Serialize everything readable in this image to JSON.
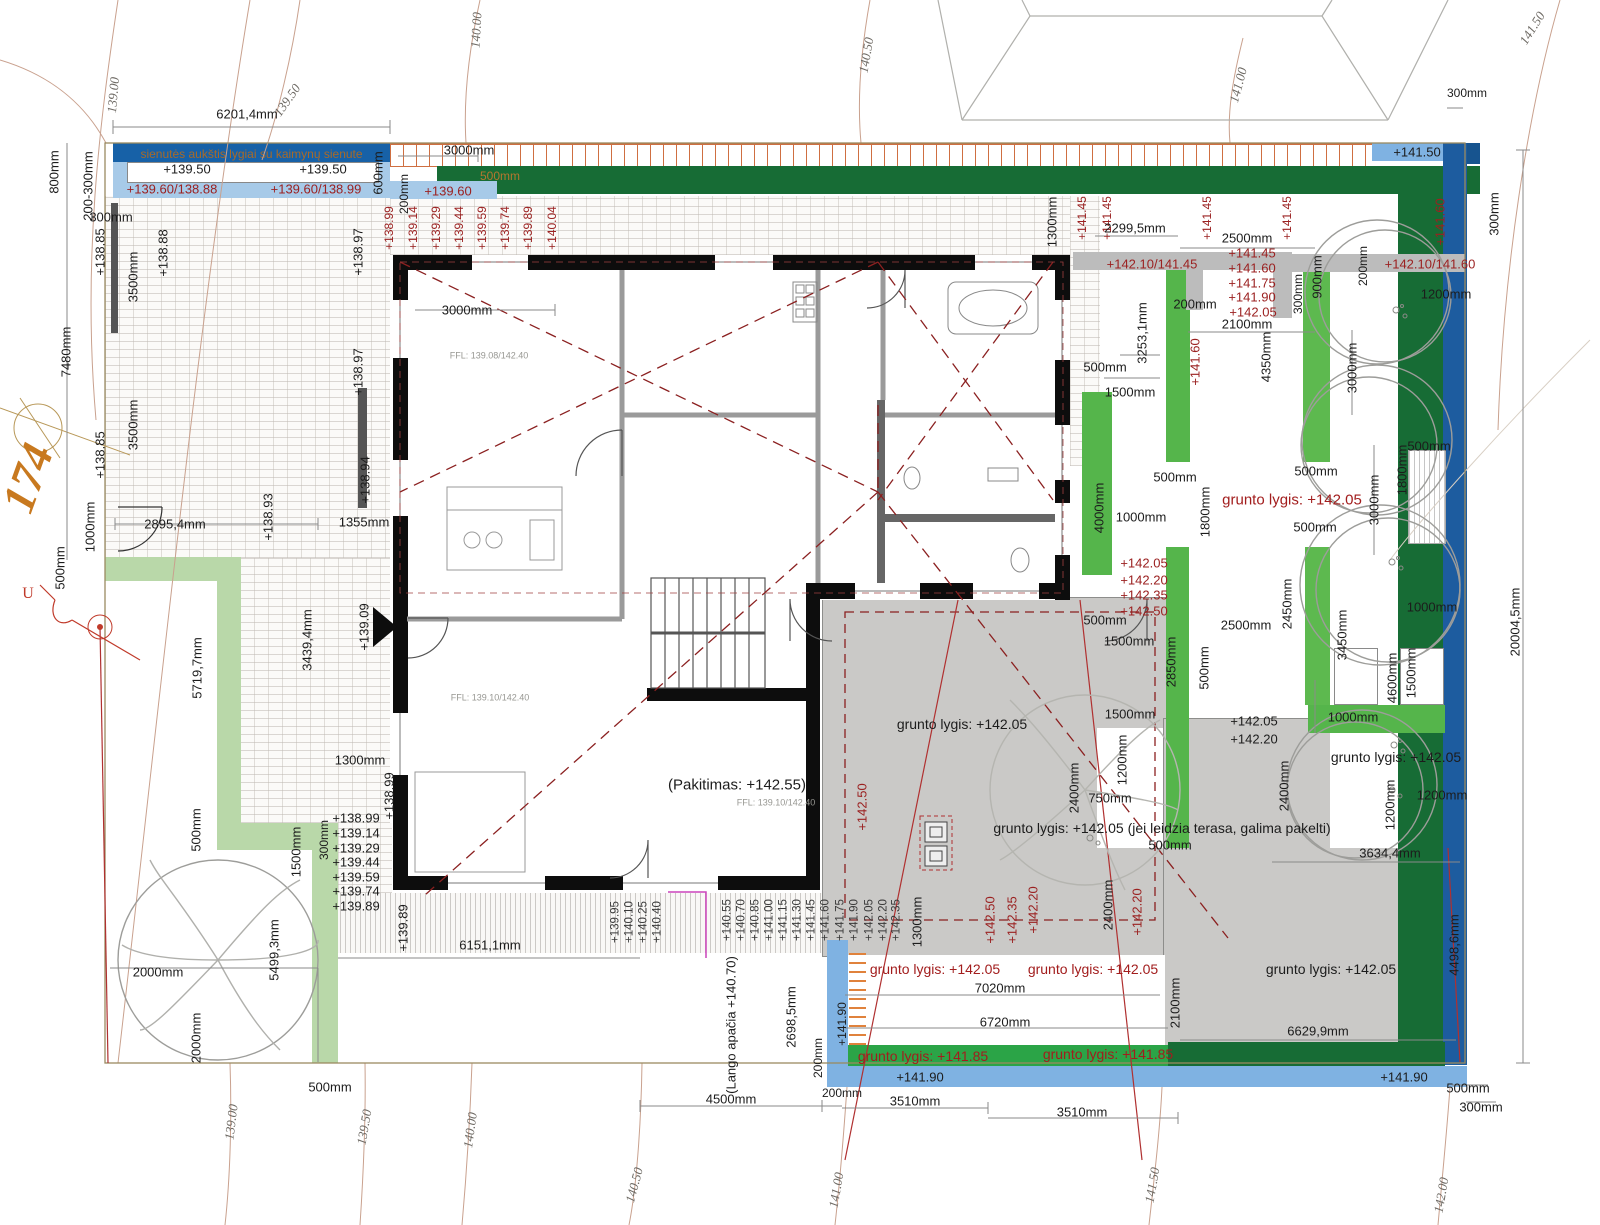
{
  "header": {
    "wall_note": "sienutės aukštis lygiai su kaimynų sienute"
  },
  "colors": {
    "navy_bar": "#1761a7",
    "light_blue": "#a7cae8",
    "blue_strip": "#7fb2e2",
    "dark_green": "#176c35",
    "bright_green": "#55b54b",
    "bottom_green": "#2ba447",
    "pale_green": "#b9d8a9",
    "terrace_gray": "#cac9c7",
    "wall_gray": "#bcbcbc",
    "elevation_red": "#9b2121",
    "fence_orange": "#cf6f41",
    "wall_black": "#0d0d0d",
    "right_blue": "#1d5c9f"
  },
  "labels": [
    {
      "t": "139.00",
      "x": 113,
      "y": 95,
      "r": -85,
      "c": "ct"
    },
    {
      "t": "139.50",
      "x": 287,
      "y": 100,
      "r": -55,
      "c": "ct"
    },
    {
      "t": "140.00",
      "x": 476,
      "y": 30,
      "r": -87,
      "c": "ct"
    },
    {
      "t": "140.50",
      "x": 866,
      "y": 55,
      "r": -80,
      "c": "ct"
    },
    {
      "t": "141.00",
      "x": 1238,
      "y": 85,
      "r": -75,
      "c": "ct"
    },
    {
      "t": "141.50",
      "x": 1532,
      "y": 28,
      "r": -58,
      "c": "ct"
    },
    {
      "t": "139.00",
      "x": 231,
      "y": 1122,
      "r": -83,
      "c": "ct"
    },
    {
      "t": "139.50",
      "x": 364,
      "y": 1127,
      "r": -80,
      "c": "ct"
    },
    {
      "t": "140.00",
      "x": 470,
      "y": 1130,
      "r": -82,
      "c": "ct"
    },
    {
      "t": "140.50",
      "x": 634,
      "y": 1185,
      "r": -75,
      "c": "ct"
    },
    {
      "t": "141.00",
      "x": 836,
      "y": 1190,
      "r": -80,
      "c": "ct"
    },
    {
      "t": "141.50",
      "x": 1152,
      "y": 1185,
      "r": -80,
      "c": "ct"
    },
    {
      "t": "142.00",
      "x": 1441,
      "y": 1195,
      "r": -80,
      "c": "ct"
    },
    {
      "t": "6201,4mm",
      "x": 247,
      "y": 114
    },
    {
      "t": "200-300mm",
      "x": 88,
      "y": 186,
      "r": -90
    },
    {
      "t": "800mm",
      "x": 54,
      "y": 172,
      "r": -90
    },
    {
      "t": "+139.50",
      "x": 187,
      "y": 169
    },
    {
      "t": "+139.50",
      "x": 323,
      "y": 169
    },
    {
      "t": "+139.60/138.88",
      "x": 172,
      "y": 189,
      "c": "red"
    },
    {
      "t": "+139.60/138.99",
      "x": 316,
      "y": 189,
      "c": "red"
    },
    {
      "t": "600mm",
      "x": 378,
      "y": 173,
      "r": -90
    },
    {
      "t": "3000mm",
      "x": 469,
      "y": 150
    },
    {
      "t": "500mm",
      "x": 500,
      "y": 176,
      "c": "grn",
      "s": 12
    },
    {
      "t": "+139.60",
      "x": 448,
      "y": 191,
      "c": "red"
    },
    {
      "t": "200mm",
      "x": 404,
      "y": 194,
      "r": -90,
      "s": 12
    },
    {
      "t": "300mm",
      "x": 111,
      "y": 217
    },
    {
      "t": "+138.85",
      "x": 100,
      "y": 252,
      "r": -90
    },
    {
      "t": "3500mm",
      "x": 133,
      "y": 277,
      "r": -90
    },
    {
      "t": "+138.88",
      "x": 163,
      "y": 253,
      "r": -90
    },
    {
      "t": "+138.97",
      "x": 358,
      "y": 252,
      "r": -90
    },
    {
      "t": "+138.97",
      "x": 358,
      "y": 372,
      "r": -90
    },
    {
      "t": "3500mm",
      "x": 133,
      "y": 425,
      "r": -90
    },
    {
      "t": "+138.85",
      "x": 100,
      "y": 455,
      "r": -90
    },
    {
      "t": "+138.94",
      "x": 365,
      "y": 480,
      "r": -90
    },
    {
      "t": "+138.93",
      "x": 268,
      "y": 517,
      "r": -90
    },
    {
      "t": "7480mm",
      "x": 66,
      "y": 352,
      "r": -90
    },
    {
      "t": "174",
      "x": 28,
      "y": 478,
      "r": -70,
      "c": "big",
      "s": 46
    },
    {
      "t": "U",
      "x": 28,
      "y": 594,
      "c": "u",
      "s": 16
    },
    {
      "t": "1000mm",
      "x": 90,
      "y": 527,
      "r": -90
    },
    {
      "t": "500mm",
      "x": 60,
      "y": 568,
      "r": -90
    },
    {
      "t": "2895,4mm",
      "x": 175,
      "y": 524
    },
    {
      "t": "1355mm",
      "x": 364,
      "y": 522
    },
    {
      "t": "5719,7mm",
      "x": 197,
      "y": 668,
      "r": -90
    },
    {
      "t": "3439,4mm",
      "x": 307,
      "y": 640,
      "r": -90
    },
    {
      "t": "+139.09",
      "x": 364,
      "y": 627,
      "r": -90
    },
    {
      "t": "1300mm",
      "x": 360,
      "y": 760
    },
    {
      "t": "+138.99",
      "x": 389,
      "y": 796,
      "r": -90
    },
    {
      "t": "2000mm",
      "x": 158,
      "y": 972
    },
    {
      "t": "2000mm",
      "x": 196,
      "y": 1038,
      "r": -90
    },
    {
      "t": "5499,3mm",
      "x": 274,
      "y": 950,
      "r": -90
    },
    {
      "t": "500mm",
      "x": 196,
      "y": 830,
      "r": -90
    },
    {
      "t": "1500mm",
      "x": 296,
      "y": 852,
      "r": -90
    },
    {
      "t": "300mm",
      "x": 324,
      "y": 840,
      "r": -90,
      "s": 12
    },
    {
      "t": "+138.99",
      "x": 356,
      "y": 818
    },
    {
      "t": "+139.14",
      "x": 356,
      "y": 833
    },
    {
      "t": "+139.29",
      "x": 356,
      "y": 848
    },
    {
      "t": "+139.44",
      "x": 356,
      "y": 862
    },
    {
      "t": "+139.59",
      "x": 356,
      "y": 877
    },
    {
      "t": "+139.74",
      "x": 356,
      "y": 891
    },
    {
      "t": "+139.89",
      "x": 356,
      "y": 906
    },
    {
      "t": "+139.89",
      "x": 403,
      "y": 928,
      "r": -90
    },
    {
      "t": "6151,1mm",
      "x": 490,
      "y": 945
    },
    {
      "t": "500mm",
      "x": 330,
      "y": 1087
    },
    {
      "t": "1300mm",
      "x": 917,
      "y": 922,
      "r": -90
    },
    {
      "t": "+138.99",
      "x": 389,
      "y": 228,
      "r": -90,
      "c": "red",
      "s": 12
    },
    {
      "t": "+139.14",
      "x": 413,
      "y": 228,
      "r": -90,
      "c": "red",
      "s": 12
    },
    {
      "t": "+139.29",
      "x": 436,
      "y": 228,
      "r": -90,
      "c": "red",
      "s": 12
    },
    {
      "t": "+139.44",
      "x": 459,
      "y": 228,
      "r": -90,
      "c": "red",
      "s": 12
    },
    {
      "t": "+139.59",
      "x": 482,
      "y": 228,
      "r": -90,
      "c": "red",
      "s": 12
    },
    {
      "t": "+139.74",
      "x": 505,
      "y": 228,
      "r": -90,
      "c": "red",
      "s": 12
    },
    {
      "t": "+139.89",
      "x": 528,
      "y": 228,
      "r": -90,
      "c": "red",
      "s": 12
    },
    {
      "t": "+140.04",
      "x": 552,
      "y": 228,
      "r": -90,
      "c": "red",
      "s": 12
    },
    {
      "t": "3000mm",
      "x": 467,
      "y": 310
    },
    {
      "t": "FFL: 139.08/142.40",
      "x": 489,
      "y": 356,
      "c": "ffl",
      "s": 9
    },
    {
      "t": "FFL: 139.10/142.40",
      "x": 490,
      "y": 698,
      "c": "ffl",
      "s": 9
    },
    {
      "t": "(Pakitimas: +142.55)",
      "x": 737,
      "y": 785,
      "s": 15
    },
    {
      "t": "FFL: 139.10/142.40",
      "x": 776,
      "y": 803,
      "c": "ffl",
      "s": 9
    },
    {
      "t": "+139.95",
      "x": 616,
      "y": 922,
      "r": -90,
      "c": "drk",
      "s": 11.5
    },
    {
      "t": "+140.10",
      "x": 630,
      "y": 922,
      "r": -90,
      "c": "drk",
      "s": 11.5
    },
    {
      "t": "+140.25",
      "x": 644,
      "y": 922,
      "r": -90,
      "c": "drk",
      "s": 11.5
    },
    {
      "t": "+140.40",
      "x": 658,
      "y": 922,
      "r": -90,
      "c": "drk",
      "s": 11.5
    },
    {
      "t": "+140.55",
      "x": 728,
      "y": 920,
      "r": -90,
      "c": "drk",
      "s": 11.5
    },
    {
      "t": "+140.70",
      "x": 742,
      "y": 920,
      "r": -90,
      "c": "drk",
      "s": 11.5
    },
    {
      "t": "+140.85",
      "x": 756,
      "y": 920,
      "r": -90,
      "c": "drk",
      "s": 11.5
    },
    {
      "t": "+141.00",
      "x": 770,
      "y": 920,
      "r": -90,
      "c": "drk",
      "s": 11.5
    },
    {
      "t": "+141.15",
      "x": 784,
      "y": 920,
      "r": -90,
      "c": "drk",
      "s": 11.5
    },
    {
      "t": "+141.30",
      "x": 798,
      "y": 920,
      "r": -90,
      "c": "drk",
      "s": 11.5
    },
    {
      "t": "+141.45",
      "x": 812,
      "y": 920,
      "r": -90,
      "c": "drk",
      "s": 11.5
    },
    {
      "t": "+141.60",
      "x": 826,
      "y": 920,
      "r": -90,
      "c": "drk",
      "s": 11.5
    },
    {
      "t": "+141.75",
      "x": 841,
      "y": 920,
      "r": -90,
      "c": "drk",
      "s": 11.5
    },
    {
      "t": "+141.90",
      "x": 855,
      "y": 920,
      "r": -90,
      "c": "drk",
      "s": 11.5
    },
    {
      "t": "+142.05",
      "x": 870,
      "y": 920,
      "r": -90,
      "c": "drk",
      "s": 11.5
    },
    {
      "t": "+142.20",
      "x": 884,
      "y": 920,
      "r": -90,
      "c": "drk",
      "s": 11.5
    },
    {
      "t": "+142.35",
      "x": 897,
      "y": 920,
      "r": -90,
      "c": "drk",
      "s": 11.5
    },
    {
      "t": "(Lango apačia +140.70)",
      "x": 731,
      "y": 1025,
      "r": -90
    },
    {
      "t": "2698,5mm",
      "x": 791,
      "y": 1017,
      "r": -90
    },
    {
      "t": "200mm",
      "x": 818,
      "y": 1058,
      "r": -90,
      "s": 12
    },
    {
      "t": "+141.90",
      "x": 842,
      "y": 1024,
      "r": -90,
      "s": 12
    },
    {
      "t": "4500mm",
      "x": 731,
      "y": 1099
    },
    {
      "t": "200mm",
      "x": 842,
      "y": 1093,
      "s": 12
    },
    {
      "t": "3510mm",
      "x": 915,
      "y": 1101
    },
    {
      "t": "3510mm",
      "x": 1082,
      "y": 1112
    },
    {
      "t": "grunto lygis: +142.05",
      "x": 935,
      "y": 969,
      "c": "grl",
      "s": 14
    },
    {
      "t": "grunto lygis: +142.05",
      "x": 1093,
      "y": 969,
      "c": "grl",
      "s": 14
    },
    {
      "t": "7020mm",
      "x": 1000,
      "y": 988
    },
    {
      "t": "6720mm",
      "x": 1005,
      "y": 1022
    },
    {
      "t": "grunto lygis: +141.85",
      "x": 923,
      "y": 1056,
      "c": "grl",
      "s": 14
    },
    {
      "t": "grunto lygis: +141.85",
      "x": 1108,
      "y": 1054,
      "c": "grl",
      "s": 14
    },
    {
      "t": "+141.90",
      "x": 920,
      "y": 1077
    },
    {
      "t": "+141.90",
      "x": 1404,
      "y": 1077
    },
    {
      "t": "+142.50",
      "x": 862,
      "y": 807,
      "r": -90,
      "c": "red"
    },
    {
      "t": "+142.50",
      "x": 990,
      "y": 920,
      "r": -90,
      "c": "red"
    },
    {
      "t": "+142.35",
      "x": 1012,
      "y": 920,
      "r": -90,
      "c": "red"
    },
    {
      "t": "+142.20",
      "x": 1033,
      "y": 910,
      "r": -90,
      "c": "red"
    },
    {
      "t": "+142.20",
      "x": 1137,
      "y": 912,
      "r": -90,
      "c": "red"
    },
    {
      "t": "grunto lygis: +142.05",
      "x": 962,
      "y": 724,
      "s": 14
    },
    {
      "t": "+141.50",
      "x": 1417,
      "y": 152
    },
    {
      "t": "300mm",
      "x": 1467,
      "y": 93,
      "s": 12
    },
    {
      "t": "1300mm",
      "x": 1052,
      "y": 222,
      "r": -90
    },
    {
      "t": "+141.45",
      "x": 1082,
      "y": 218,
      "r": -90,
      "c": "red",
      "s": 12
    },
    {
      "t": "+141.45",
      "x": 1107,
      "y": 218,
      "r": -90,
      "c": "red",
      "s": 12
    },
    {
      "t": "2299,5mm",
      "x": 1135,
      "y": 228
    },
    {
      "t": "+141.45",
      "x": 1207,
      "y": 218,
      "r": -90,
      "c": "red",
      "s": 12
    },
    {
      "t": "+141.45",
      "x": 1287,
      "y": 218,
      "r": -90,
      "c": "red",
      "s": 12
    },
    {
      "t": "2500mm",
      "x": 1247,
      "y": 238
    },
    {
      "t": "+141.45",
      "x": 1252,
      "y": 253,
      "c": "red"
    },
    {
      "t": "+141.60",
      "x": 1252,
      "y": 268,
      "c": "red"
    },
    {
      "t": "+141.75",
      "x": 1252,
      "y": 283,
      "c": "red"
    },
    {
      "t": "+141.90",
      "x": 1252,
      "y": 297,
      "c": "red"
    },
    {
      "t": "+142.05",
      "x": 1253,
      "y": 312,
      "c": "red"
    },
    {
      "t": "+142.10/141.45",
      "x": 1152,
      "y": 264,
      "c": "red"
    },
    {
      "t": "+142.10/141.60",
      "x": 1430,
      "y": 264,
      "c": "red"
    },
    {
      "t": "2100mm",
      "x": 1247,
      "y": 324
    },
    {
      "t": "200mm",
      "x": 1195,
      "y": 304
    },
    {
      "t": "900mm",
      "x": 1317,
      "y": 277,
      "r": -90
    },
    {
      "t": "300mm",
      "x": 1298,
      "y": 294,
      "r": -90,
      "s": 12
    },
    {
      "t": "200mm",
      "x": 1363,
      "y": 266,
      "r": -90,
      "s": 12
    },
    {
      "t": "1200mm",
      "x": 1446,
      "y": 294
    },
    {
      "t": "300mm",
      "x": 1494,
      "y": 214,
      "r": -90
    },
    {
      "t": "+141.60",
      "x": 1440,
      "y": 222,
      "r": -90,
      "c": "red"
    },
    {
      "t": "3253,1mm",
      "x": 1142,
      "y": 333,
      "r": -90
    },
    {
      "t": "500mm",
      "x": 1105,
      "y": 367
    },
    {
      "t": "1500mm",
      "x": 1130,
      "y": 392
    },
    {
      "t": "+141.60",
      "x": 1195,
      "y": 362,
      "r": -90,
      "c": "red"
    },
    {
      "t": "4350mm",
      "x": 1266,
      "y": 357,
      "r": -90
    },
    {
      "t": "4000mm",
      "x": 1099,
      "y": 508,
      "r": -90
    },
    {
      "t": "500mm",
      "x": 1175,
      "y": 477
    },
    {
      "t": "500mm",
      "x": 1316,
      "y": 471
    },
    {
      "t": "500mm",
      "x": 1315,
      "y": 527
    },
    {
      "t": "1800mm",
      "x": 1205,
      "y": 512,
      "r": -90
    },
    {
      "t": "grunto lygis: +142.05",
      "x": 1292,
      "y": 500,
      "c": "grl",
      "s": 15
    },
    {
      "t": "1000mm",
      "x": 1141,
      "y": 517
    },
    {
      "t": "3000mm",
      "x": 1352,
      "y": 368,
      "r": -90
    },
    {
      "t": "3000mm",
      "x": 1374,
      "y": 500,
      "r": -90
    },
    {
      "t": "1800mm",
      "x": 1402,
      "y": 470,
      "r": -90
    },
    {
      "t": "500mm",
      "x": 1429,
      "y": 446
    },
    {
      "t": "1000mm",
      "x": 1432,
      "y": 607
    },
    {
      "t": "3450mm",
      "x": 1342,
      "y": 635,
      "r": -90
    },
    {
      "t": "4600mm",
      "x": 1392,
      "y": 678,
      "r": -90
    },
    {
      "t": "1500mm",
      "x": 1411,
      "y": 673,
      "r": -90
    },
    {
      "t": "+142.05",
      "x": 1144,
      "y": 563,
      "c": "red"
    },
    {
      "t": "+142.20",
      "x": 1144,
      "y": 580,
      "c": "red"
    },
    {
      "t": "+142.35",
      "x": 1144,
      "y": 595,
      "c": "red"
    },
    {
      "t": "+142.50",
      "x": 1144,
      "y": 611,
      "c": "red"
    },
    {
      "t": "500mm",
      "x": 1105,
      "y": 620
    },
    {
      "t": "1500mm",
      "x": 1129,
      "y": 641
    },
    {
      "t": "2850mm",
      "x": 1171,
      "y": 662,
      "r": -90
    },
    {
      "t": "2500mm",
      "x": 1246,
      "y": 625
    },
    {
      "t": "2450mm",
      "x": 1287,
      "y": 604,
      "r": -90
    },
    {
      "t": "500mm",
      "x": 1204,
      "y": 668,
      "r": -90
    },
    {
      "t": "1500mm",
      "x": 1130,
      "y": 714
    },
    {
      "t": "+142.05",
      "x": 1254,
      "y": 721
    },
    {
      "t": "+142.20",
      "x": 1254,
      "y": 739
    },
    {
      "t": "1000mm",
      "x": 1353,
      "y": 717
    },
    {
      "t": "grunto lygis: +142.05",
      "x": 1396,
      "y": 757,
      "s": 14
    },
    {
      "t": "1200mm",
      "x": 1390,
      "y": 805,
      "r": -90
    },
    {
      "t": "1200mm",
      "x": 1442,
      "y": 795
    },
    {
      "t": "1200mm",
      "x": 1122,
      "y": 760,
      "r": -90
    },
    {
      "t": "750mm",
      "x": 1110,
      "y": 798
    },
    {
      "t": "2400mm",
      "x": 1074,
      "y": 788,
      "r": -90
    },
    {
      "t": "2400mm",
      "x": 1284,
      "y": 786,
      "r": -90
    },
    {
      "t": "2400mm",
      "x": 1108,
      "y": 905,
      "r": -90
    },
    {
      "t": "grunto lygis: +142.05 (jei leidzia terasa, galima pakelti)",
      "x": 1162,
      "y": 828,
      "s": 14
    },
    {
      "t": "500mm",
      "x": 1170,
      "y": 845
    },
    {
      "t": "3634,4mm",
      "x": 1390,
      "y": 853
    },
    {
      "t": "grunto lygis: +142.05",
      "x": 1331,
      "y": 969,
      "s": 14
    },
    {
      "t": "6629,9mm",
      "x": 1318,
      "y": 1031
    },
    {
      "t": "2100mm",
      "x": 1175,
      "y": 1003,
      "r": -90
    },
    {
      "t": "4498,6mm",
      "x": 1454,
      "y": 945,
      "r": -90
    },
    {
      "t": "20004,5mm",
      "x": 1515,
      "y": 622,
      "r": -90
    },
    {
      "t": "500mm",
      "x": 1468,
      "y": 1088
    },
    {
      "t": "300mm",
      "x": 1481,
      "y": 1107
    }
  ]
}
